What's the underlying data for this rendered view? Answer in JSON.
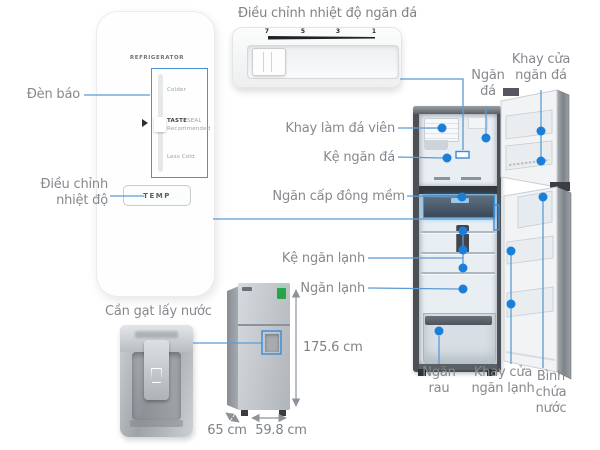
{
  "panel": {
    "title": "REFRIGERATOR",
    "colder": "Colder",
    "taste": "TASTE",
    "seal": "SEAL",
    "recommended": "Recommended",
    "less_cold": "Less Cold",
    "temp_button": "TEMP"
  },
  "panel_labels": {
    "den_bao": "Đèn báo",
    "dieu_chinh": [
      "Điều chỉnh",
      "nhiệt độ"
    ]
  },
  "slider": {
    "title": "Điều chỉnh nhiệt độ ngăn đá",
    "ticks": [
      "7",
      "5",
      "3",
      "1"
    ]
  },
  "parts": {
    "khay_cua_ngan_da": [
      "Khay cửa",
      "ngăn đá"
    ],
    "ngan_da": [
      "Ngăn",
      "đá"
    ],
    "khay_lam_da_vien": "Khay làm đá viên",
    "ke_ngan_da": "Kệ ngăn đá",
    "ngan_cap_dong_mem": "Ngăn cấp đông mềm",
    "ke_ngan_lanh": "Kệ ngăn lạnh",
    "ngan_lanh": "Ngăn lạnh",
    "ngan_rau": [
      "Ngăn",
      "rau"
    ],
    "khay_cua_ngan_lanh": [
      "Khay cửa",
      "ngăn lạnh"
    ],
    "binh_chua_nuoc": [
      "Bình",
      "chứa",
      "nước"
    ]
  },
  "dispenser": {
    "label": "Cần gạt lấy nước"
  },
  "dimensions": {
    "height": "175.6 cm",
    "depth": "65 cm",
    "width": "59.8 cm"
  },
  "colors": {
    "dot_blue": "#1b7ed9",
    "line_blue": "#5b9bd5",
    "highlight_blue": "#3b8ad8",
    "label_gray": "#85898e",
    "dimension_gray": "#8d9298",
    "energy_green": "#27a349"
  }
}
